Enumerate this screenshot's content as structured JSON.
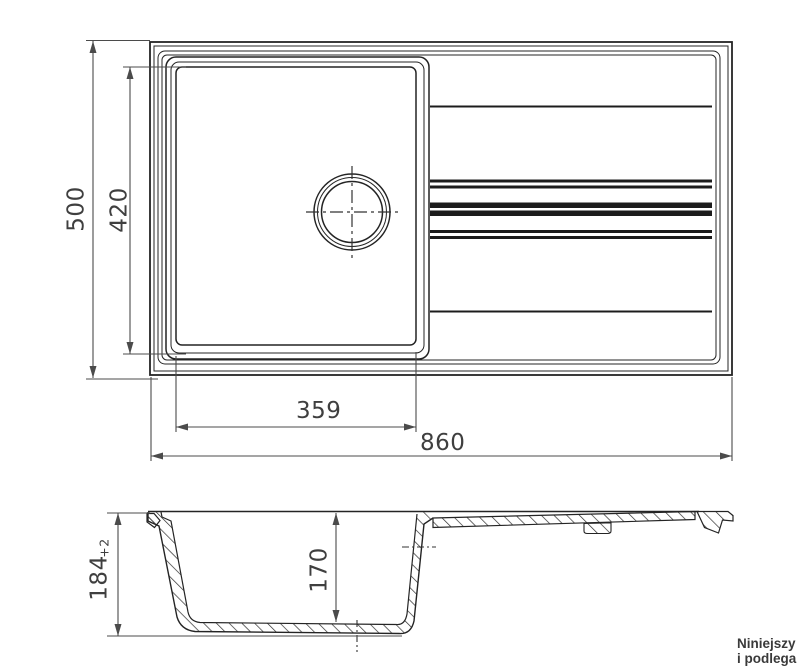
{
  "drawing": {
    "views": {
      "top_view": {
        "dims": {
          "overall_height": "500",
          "bowl_height": "420",
          "bowl_width": "359",
          "overall_width": "860"
        }
      },
      "section_view": {
        "dims": {
          "overall_depth": "184",
          "depth_tolerance": "+2",
          "bowl_depth": "170"
        }
      }
    },
    "note": {
      "line1": "Niniejszy",
      "line2": "i podlega"
    },
    "colors": {
      "line": "#242424",
      "dimension_line": "#4b4b4b",
      "label_text": "#3f3f3f",
      "background": "#ffffff"
    }
  }
}
